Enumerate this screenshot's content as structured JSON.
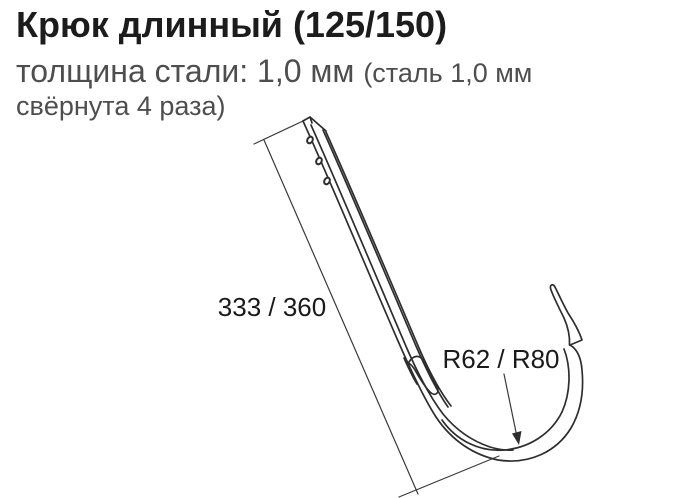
{
  "header": {
    "title": "Крюк длинный (125/150)",
    "subtitle_main": "толщина стали: 1,0 мм ",
    "subtitle_note": "(сталь 1,0 мм свёрнута 4 раза)"
  },
  "diagram": {
    "type": "technical-line-drawing",
    "part": "long gutter hook: straight mounting strap with three screw holes and clip tab, ending in curved gutter cradle with bent tip",
    "labels": {
      "length": "333 / 360",
      "radius": "R62 / R80"
    },
    "colors": {
      "title_text": "#1c1c1c",
      "subtitle_text": "#4e4e4e",
      "drawing_line": "#2e2e2e",
      "dimension_text": "#1a1a1a",
      "background": "#ffffff"
    }
  }
}
